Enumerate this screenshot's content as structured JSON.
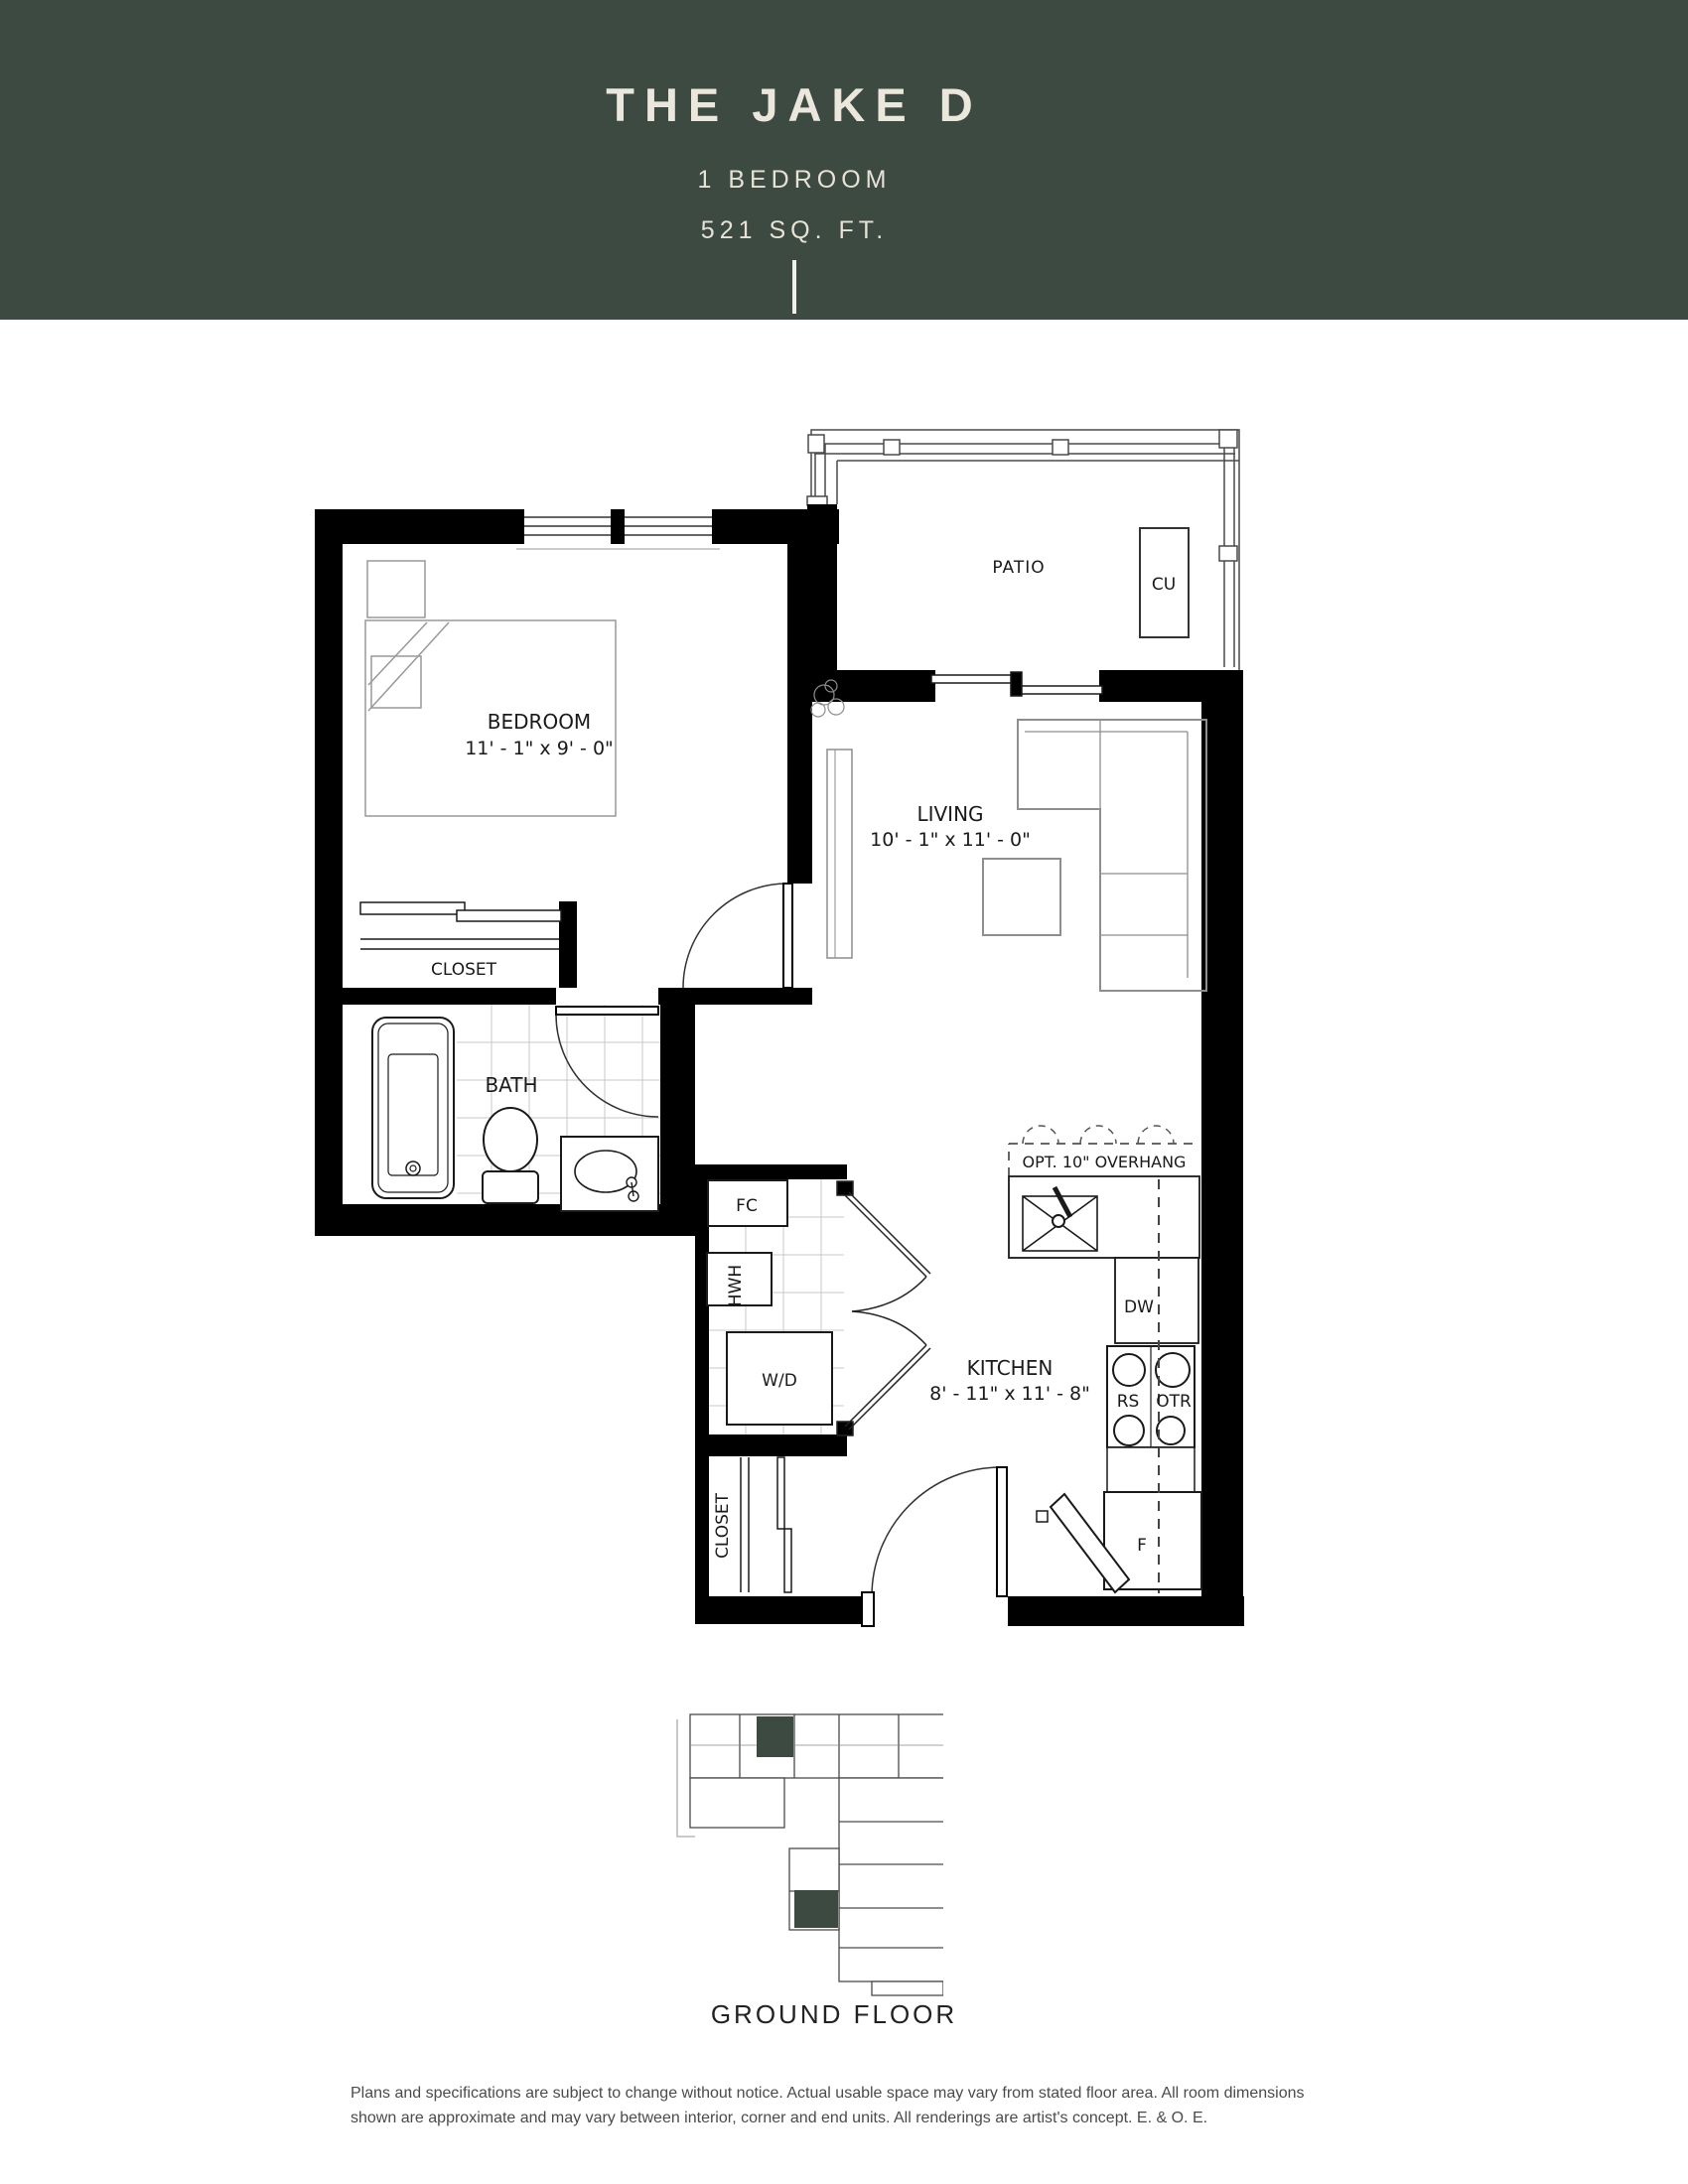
{
  "header": {
    "title": "THE JAKE D",
    "subtitle": "1 BEDROOM",
    "area": "521 SQ. FT."
  },
  "plan": {
    "bedroom": {
      "label": "BEDROOM",
      "dims": "11' - 1\" x 9' - 0\""
    },
    "living": {
      "label": "LIVING",
      "dims": "10' - 1\" x 11' - 0\""
    },
    "kitchen": {
      "label": "KITCHEN",
      "dims": "8' - 11\" x 11' - 8\""
    },
    "bath": {
      "label": "BATH"
    },
    "patio": {
      "label": "PATIO"
    },
    "closet_bedroom": {
      "label": "CLOSET"
    },
    "closet_entry": {
      "label": "CLOSET"
    },
    "labels": {
      "fc": "FC",
      "hwh": "HWH",
      "wd": "W/D",
      "dw": "DW",
      "rs": "RS",
      "otr": "OTR",
      "fridge": "F",
      "cu": "CU",
      "overhang": "OPT. 10\" OVERHANG"
    }
  },
  "keyplan": {
    "caption": "GROUND FLOOR"
  },
  "disclaimer": {
    "line1": "Plans and specifications are subject to change without notice. Actual usable space may vary from stated floor area. All room dimensions",
    "line2": "shown are approximate and may vary between interior, corner and end units. All renderings are artist's concept. E. & O. E."
  },
  "colors": {
    "header_bg": "#3d4a42",
    "header_text": "#ebe7dd",
    "wall": "#000000",
    "highlight_unit": "#3d4a42"
  }
}
